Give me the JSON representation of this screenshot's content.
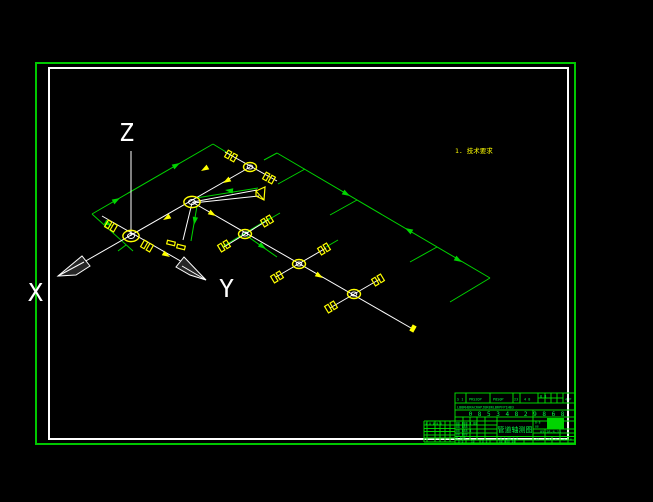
{
  "canvas": {
    "width": 653,
    "height": 502,
    "background": "#000000"
  },
  "colors": {
    "frame_green": "#00c800",
    "cad_green": "#00d400",
    "text_green": "#00ff41",
    "white": "#ffffff",
    "yellow": "#ffff00",
    "cone_fill": "#262626"
  },
  "axes": {
    "z": "Z",
    "x": "X",
    "y": "Y"
  },
  "note": {
    "text": "1. 技术要求"
  },
  "diagram": {
    "white_lines": [
      [
        131,
        151,
        131,
        236
      ],
      [
        250,
        167,
        70,
        270
      ],
      [
        225,
        152,
        277,
        181
      ],
      [
        102,
        216,
        184,
        263
      ],
      [
        192,
        202,
        411,
        328
      ],
      [
        224,
        247,
        268,
        220
      ],
      [
        276,
        277,
        326,
        248
      ],
      [
        330,
        308,
        380,
        279
      ],
      [
        193,
        202,
        257,
        190
      ],
      [
        193,
        203,
        259,
        196
      ],
      [
        192,
        203,
        183,
        240
      ]
    ],
    "green_lines": [
      [
        92,
        214,
        213,
        144
      ],
      [
        213,
        144,
        231,
        155
      ],
      [
        264,
        160,
        277,
        153
      ],
      [
        277,
        153,
        490,
        278
      ],
      [
        490,
        278,
        450,
        302
      ],
      [
        92,
        214,
        133,
        251
      ],
      [
        305,
        169,
        278,
        184
      ],
      [
        357,
        200,
        330,
        215
      ],
      [
        437,
        247,
        410,
        262
      ],
      [
        196,
        198,
        258,
        188
      ],
      [
        197,
        206,
        191,
        241
      ],
      [
        270,
        218,
        222,
        247
      ],
      [
        247,
        236,
        277,
        257
      ],
      [
        326,
        247,
        338,
        240
      ],
      [
        268,
        220,
        280,
        213
      ],
      [
        126,
        245,
        118,
        251
      ]
    ],
    "green_arrows": [
      [
        120,
        198,
        -30
      ],
      [
        180,
        163,
        -30
      ],
      [
        112,
        226,
        30
      ],
      [
        350,
        196,
        30
      ],
      [
        462,
        262,
        30
      ],
      [
        405,
        228,
        210
      ],
      [
        225,
        190,
        187
      ],
      [
        194,
        225,
        100
      ],
      [
        266,
        249,
        35
      ]
    ],
    "yellow_arrows": [
      [
        223,
        183,
        150
      ],
      [
        201,
        171,
        150
      ],
      [
        163,
        220,
        150
      ],
      [
        216,
        216,
        31
      ],
      [
        323,
        278,
        31
      ],
      [
        170,
        257,
        31
      ]
    ],
    "nodes": [
      [
        250,
        167,
        0
      ],
      [
        192,
        202,
        1
      ],
      [
        131,
        236,
        1
      ],
      [
        245,
        234,
        0
      ],
      [
        299,
        264,
        0
      ],
      [
        354,
        294,
        0
      ]
    ],
    "flanges": [
      [
        231,
        156,
        29
      ],
      [
        269,
        178,
        29
      ],
      [
        111,
        226,
        30
      ],
      [
        147,
        246,
        30
      ],
      [
        267,
        221,
        -31
      ],
      [
        224,
        246,
        -31
      ],
      [
        324,
        249,
        -31
      ],
      [
        277,
        277,
        -31
      ],
      [
        378,
        280,
        -31
      ],
      [
        331,
        307,
        -31
      ]
    ],
    "plates": [
      [
        171,
        243,
        14
      ],
      [
        181,
        247,
        14
      ]
    ],
    "valve": {
      "points": "256,191 265,187 264,200 256,196",
      "line": [
        256,
        191,
        264,
        200
      ]
    },
    "end_square": {
      "x": 413,
      "y": 328.5,
      "rot": 119,
      "w": 7,
      "h": 4.5
    },
    "cones": [
      {
        "points": "58,276 82,256 90,266 76,275",
        "shade": [
          58,
          276,
          84,
          262
        ]
      },
      {
        "points": "206,280 184,257 176,267 190,275",
        "shade": [
          206,
          280,
          182,
          266
        ]
      }
    ]
  },
  "title_block": {
    "top_cells": [
      "S 1",
      "PRS2OP",
      "P8S0P",
      "23",
      "4 8",
      "8 8",
      "4 P"
    ],
    "band_text": "LBBRHBRACRHPJBR8RLBRPFP1HB3",
    "number_row": "0 8 5 3 4 8 2 9 8 6 8",
    "title": "管道轴测图",
    "sig_rows": [
      "88 888 8 88",
      "88 888",
      "88 888 8",
      "88 888",
      "8 8 8"
    ],
    "under_title": "8 8 88 8 8",
    "date_text": "05-28-6-11",
    "right_small_1": "8-8",
    "right_small_2": "88",
    "right_cells": [
      "81",
      "45",
      "8",
      "48",
      "8"
    ],
    "bottom_cells": [
      "8-8",
      "58",
      "8 8",
      "88 888 88"
    ],
    "left_table_row": "8 8 8 8 8"
  }
}
